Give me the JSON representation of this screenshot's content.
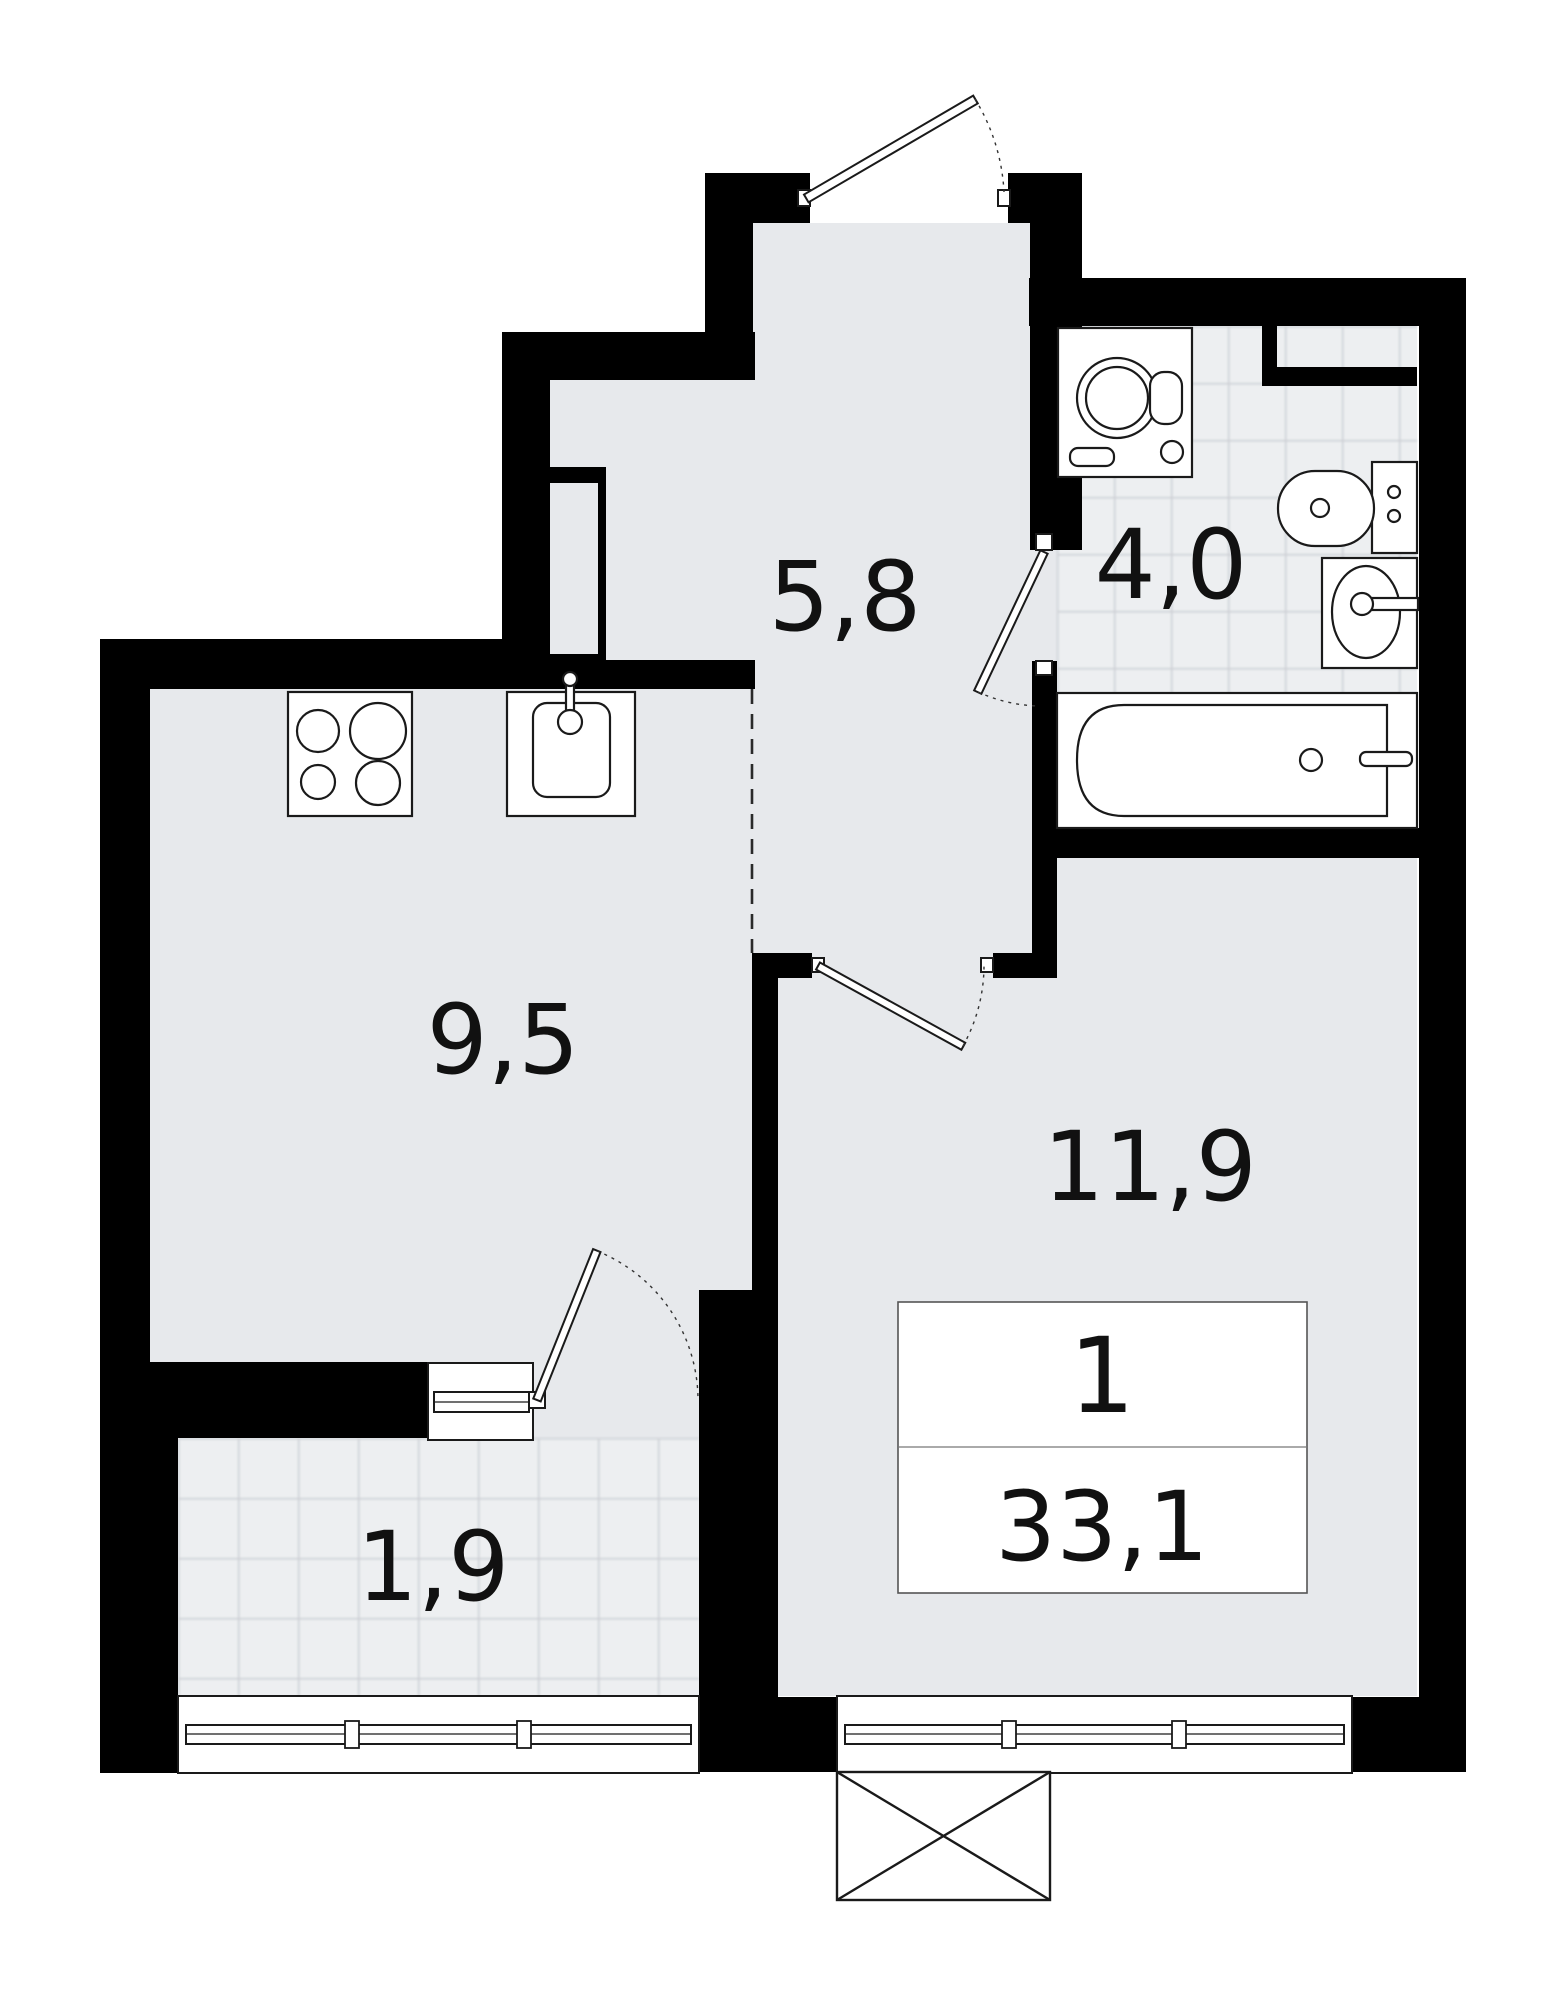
{
  "plan": {
    "type": "apartment-floor-plan",
    "rooms": {
      "hallway": {
        "area_label": "5,8"
      },
      "bathroom": {
        "area_label": "4,0"
      },
      "kitchen": {
        "area_label": "9,5"
      },
      "living_room": {
        "area_label": "11,9"
      },
      "balcony": {
        "area_label": "1,9"
      }
    },
    "summary": {
      "rooms_count": "1",
      "total_area": "33,1"
    },
    "colors": {
      "wall": "#000000",
      "floor": "#e7e9ec",
      "tile_floor": "#edeff1",
      "tile_line": "#c5c9cf",
      "line": "#1a1a1a",
      "background": "#ffffff"
    }
  }
}
